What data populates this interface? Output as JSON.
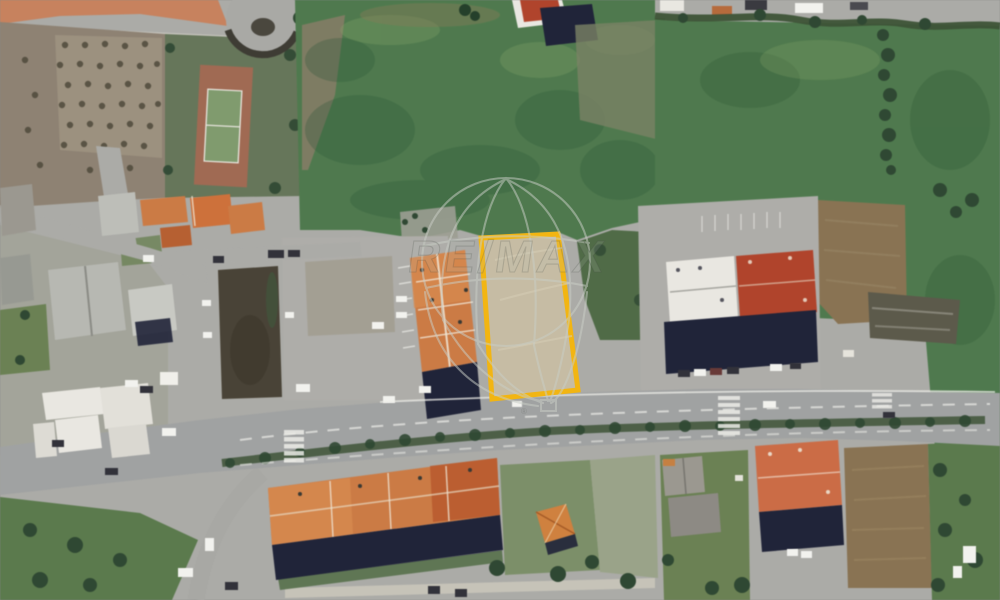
{
  "watermark": {
    "brand_text": "RE/MAX",
    "registered_mark": "®",
    "icon": "hot-air-balloon-outline-icon"
  },
  "colors": {
    "parcel_border": "#F2B512",
    "parcel_fill": "#C6BCA4",
    "road": "#ABABA7",
    "road_plaza": "#AEADA9",
    "boulevard": "#A0A2A2",
    "grass": "#4E7A4D",
    "scrub": "#4F6B46",
    "hedge": "#3D5436",
    "tree": "#2E4832",
    "dirt_grove": "#8E8272",
    "dirt_light": "#9C917E",
    "dirt_brown": "#8A7352",
    "roof_orange": "#CE7A42",
    "roof_red": "#B4432A",
    "roof_salmon": "#CE6B44",
    "roof_white": "#E9E7E1",
    "roof_gray": "#9B9890",
    "shadow": "#20243A",
    "court_outer": "#A26A52",
    "court_inner": "#7F9B6D",
    "marking": "#EDEDE8",
    "watermark_line": "#C9CEC6",
    "embankment": "#5A7A4C",
    "yard_green": "#6A8152",
    "plot_dark": "#494336"
  }
}
